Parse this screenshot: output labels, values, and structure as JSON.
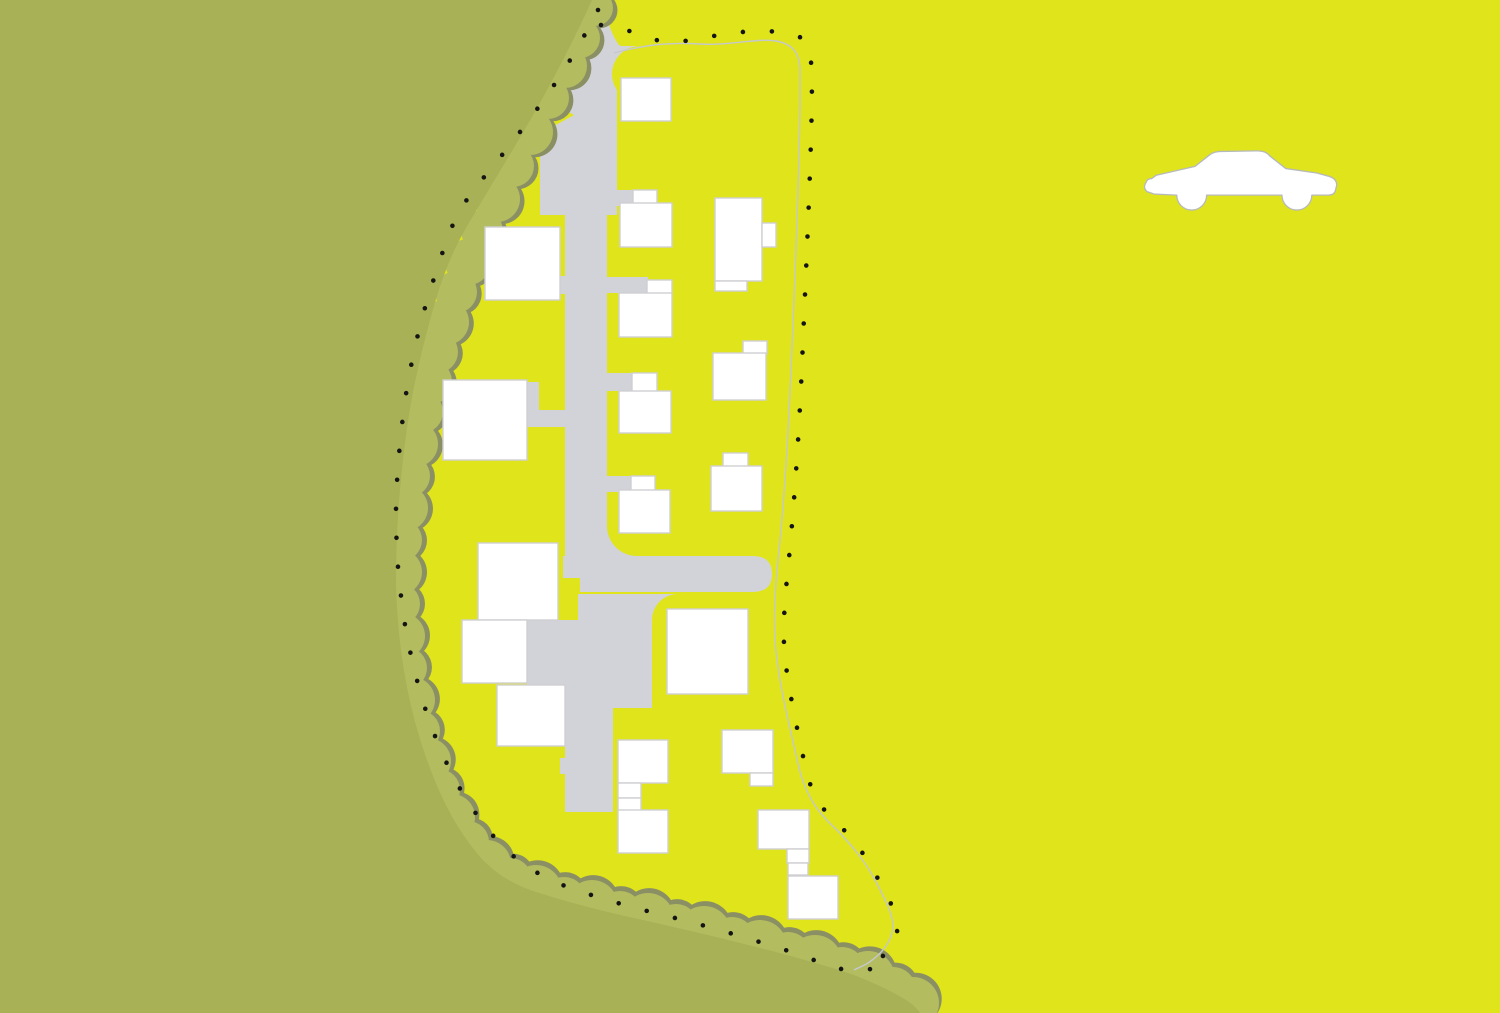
{
  "map": {
    "canvas": {
      "width": 1500,
      "height": 1013
    },
    "colors": {
      "ground_yellow": "#e0e41b",
      "canopy_olive": "#a8b156",
      "canopy_bump": "#b3bc5f",
      "canopy_bump_shadow": "#8b8f64",
      "road_gray": "#d2d3d9",
      "building_fill": "#ffffff",
      "building_stroke": "#cfcfd2",
      "boundary_solid": "#c5c8cd",
      "boundary_dot": "#141414",
      "car_fill": "#ffffff",
      "car_stroke": "#b7babc"
    },
    "canopy": {
      "mass_path": "M 0,0 L 592,0 C 575,38 556,74 536,110 C 512,152 487,192 466,228 C 452,252 442,278 434,306 C 426,334 419,362 413,392 C 407,424 403,456 400,490 C 397,522 396,554 396,586 C 397,618 400,650 406,682 C 412,714 421,746 433,776 C 444,804 458,830 476,852 C 492,872 512,884 536,892 C 570,903 606,912 643,920 C 678,928 713,936 748,945 C 778,952 808,961 836,969 C 862,977 886,988 906,1000 C 912,1004 917,1008 920,1013 L 0,1013 Z",
      "bump_shadow_offset": 5,
      "bumps": [
        [
          595,
          8,
          18
        ],
        [
          580,
          38,
          20
        ],
        [
          565,
          66,
          22
        ],
        [
          548,
          98,
          21
        ],
        [
          530,
          132,
          23
        ],
        [
          513,
          166,
          21
        ],
        [
          497,
          199,
          23
        ],
        [
          482,
          231,
          21
        ],
        [
          468,
          262,
          23
        ],
        [
          456,
          292,
          21
        ],
        [
          446,
          322,
          23
        ],
        [
          437,
          352,
          21
        ],
        [
          429,
          382,
          23
        ],
        [
          422,
          412,
          21
        ],
        [
          415,
          444,
          23
        ],
        [
          409,
          476,
          21
        ],
        [
          405,
          508,
          23
        ],
        [
          401,
          540,
          21
        ],
        [
          399,
          572,
          23
        ],
        [
          399,
          604,
          21
        ],
        [
          402,
          636,
          23
        ],
        [
          406,
          668,
          21
        ],
        [
          412,
          700,
          23
        ],
        [
          419,
          731,
          21
        ],
        [
          428,
          761,
          23
        ],
        [
          439,
          790,
          21
        ],
        [
          452,
          817,
          23
        ],
        [
          468,
          842,
          21
        ],
        [
          487,
          864,
          24
        ],
        [
          510,
          880,
          22
        ],
        [
          536,
          891,
          26
        ],
        [
          564,
          899,
          22
        ],
        [
          592,
          906,
          26
        ],
        [
          620,
          913,
          22
        ],
        [
          648,
          919,
          26
        ],
        [
          676,
          926,
          22
        ],
        [
          704,
          933,
          27
        ],
        [
          732,
          940,
          23
        ],
        [
          760,
          947,
          27
        ],
        [
          788,
          955,
          23
        ],
        [
          815,
          962,
          27
        ],
        [
          842,
          970,
          23
        ],
        [
          868,
          978,
          27
        ],
        [
          893,
          990,
          23
        ],
        [
          913,
          1003,
          26
        ]
      ]
    },
    "roads": {
      "rects": [
        [
          580,
          48,
          37,
          167
        ],
        [
          565,
          200,
          42,
          378
        ],
        [
          548,
          55,
          35,
          100
        ],
        [
          540,
          145,
          43,
          70
        ],
        [
          613,
          190,
          21,
          16
        ],
        [
          605,
          277,
          43,
          16
        ],
        [
          605,
          373,
          28,
          18
        ],
        [
          605,
          476,
          27,
          16
        ],
        [
          552,
          276,
          15,
          18
        ],
        [
          527,
          382,
          12,
          45
        ],
        [
          527,
          410,
          41,
          17
        ],
        [
          578,
          594,
          74,
          114
        ],
        [
          565,
          685,
          48,
          127
        ],
        [
          527,
          620,
          51,
          65
        ],
        [
          560,
          758,
          22,
          16
        ]
      ],
      "paths": [
        "M 586,0 L 603,0 C 607,20 611,34 619,45 C 627,50 634,51 642,51 L 642,58 L 580,58 L 580,40 C 583,28 585,14 586,0 Z",
        "M 563,556 L 752,556 C 766,556 772,562 772,574 C 772,586 766,592 752,592 L 580,592 L 580,578 L 563,578 Z"
      ],
      "fillets": [
        {
          "square": [
            612,
            46,
            28,
            28
          ],
          "circle": [
            640,
            74,
            28
          ]
        },
        {
          "square": [
            607,
            526,
            30,
            30
          ],
          "circle": [
            637,
            526,
            30
          ]
        },
        {
          "square": [
            652,
            594,
            26,
            26
          ],
          "circle": [
            678,
            620,
            26
          ]
        }
      ],
      "arrow_wedge": "552,103 552,127 574,115"
    },
    "boundary": {
      "solid_path": "M 614,53 C 645,45 668,42 700,44 C 728,46 755,38 776,41 C 793,44 799,53 800,68 L 800,105 C 799,180 795,280 791,370 C 788,440 784,505 778,560 C 774,600 773,630 777,660 C 781,692 790,728 799,768 C 808,803 823,817 839,832 C 852,846 865,861 875,880 C 884,897 893,914 893,926 C 892,941 883,953 868,963 C 863,966 858,968 854,970",
      "dotted_paths": [
        "M 598,10 C 585,35 570,62 552,88 C 530,120 505,152 480,182 C 465,200 452,222 444,248 C 436,272 428,296 421,322 C 414,350 408,378 404,408 C 400,440 397,472 396,504 C 396,536 397,566 401,596 C 404,624 410,654 418,684 C 426,714 437,744 451,772 C 463,796 478,818 495,838 C 514,860 537,875 565,886 C 595,897 627,906 659,914 C 692,922 724,931 756,941 C 782,948 808,958 833,967 C 846,971 860,971 871,969",
        "M 601,25 C 622,28 641,34 659,41 C 680,44 702,38 724,34 C 746,31 768,30 789,33 C 804,36 810,45 811,60 L 812,95 C 811,160 807,250 803,340 C 800,420 795,495 789,558 C 785,598 782,628 785,658 C 789,692 797,728 806,770 C 813,800 827,815 843,829 C 856,843 868,859 878,879 C 887,896 897,913 898,925 C 897,940 888,952 873,966"
      ]
    },
    "buildings": [
      {
        "id": "west-1",
        "rects": [
          [
            485,
            227,
            75,
            73
          ]
        ]
      },
      {
        "id": "west-2",
        "rects": [
          [
            443,
            380,
            84,
            80
          ]
        ]
      },
      {
        "id": "west-3",
        "rects": [
          [
            478,
            543,
            80,
            77
          ]
        ]
      },
      {
        "id": "west-4",
        "rects": [
          [
            462,
            620,
            65,
            63
          ]
        ]
      },
      {
        "id": "west-5",
        "rects": [
          [
            497,
            685,
            68,
            61
          ]
        ]
      },
      {
        "id": "mid-1",
        "rects": [
          [
            621,
            78,
            50,
            43
          ]
        ]
      },
      {
        "id": "mid-2",
        "rects": [
          [
            633,
            190,
            24,
            14
          ],
          [
            620,
            203,
            52,
            44
          ]
        ]
      },
      {
        "id": "mid-3",
        "rects": [
          [
            647,
            280,
            25,
            14
          ],
          [
            619,
            293,
            53,
            44
          ]
        ]
      },
      {
        "id": "mid-4",
        "rects": [
          [
            632,
            373,
            25,
            19
          ],
          [
            619,
            391,
            52,
            42
          ]
        ]
      },
      {
        "id": "mid-5",
        "rects": [
          [
            631,
            476,
            24,
            15
          ],
          [
            619,
            490,
            51,
            43
          ]
        ]
      },
      {
        "id": "mid-6",
        "rects": [
          [
            618,
            740,
            50,
            43
          ],
          [
            618,
            783,
            23,
            15
          ],
          [
            618,
            798,
            23,
            13
          ],
          [
            618,
            810,
            50,
            43
          ]
        ]
      },
      {
        "id": "east-1",
        "rects": [
          [
            715,
            198,
            47,
            83
          ],
          [
            762,
            223,
            14,
            24
          ],
          [
            715,
            281,
            32,
            10
          ]
        ]
      },
      {
        "id": "east-2",
        "rects": [
          [
            743,
            341,
            24,
            13
          ],
          [
            713,
            353,
            53,
            47
          ]
        ]
      },
      {
        "id": "east-3",
        "rects": [
          [
            723,
            453,
            25,
            14
          ],
          [
            711,
            466,
            51,
            45
          ]
        ]
      },
      {
        "id": "east-4",
        "rects": [
          [
            667,
            609,
            81,
            85
          ]
        ]
      },
      {
        "id": "east-5",
        "rects": [
          [
            722,
            730,
            51,
            43
          ],
          [
            750,
            773,
            23,
            13
          ]
        ]
      },
      {
        "id": "east-6",
        "rects": [
          [
            758,
            810,
            51,
            39
          ],
          [
            787,
            849,
            22,
            14
          ],
          [
            788,
            863,
            20,
            12
          ]
        ]
      },
      {
        "id": "east-7",
        "rects": [
          [
            788,
            876,
            50,
            43
          ]
        ]
      }
    ],
    "car": {
      "x": 1143,
      "y": 142,
      "scale": 1.107,
      "path": "M 10,47 L 4,45 C 1,43 1,40 2,38 L 3,36 C 3.5,34 5,33 8,33 L 12,30 L 47,22 L 61,11 C 64,9 67,8.5 71,8.5 L 103,8 C 109,8 112,9.5 115,13 L 129,24 L 157,28 L 168,31 C 173,32.5 175,35 175,39 L 174,43 C 173.5,46.5 171,48 167,48 L 152.5,48 a 13.5,13.5 0 1 1 -27,0 L 57.5,48 a 13.5,13.5 0 1 1 -27,0 L 10,47 Z"
    }
  }
}
